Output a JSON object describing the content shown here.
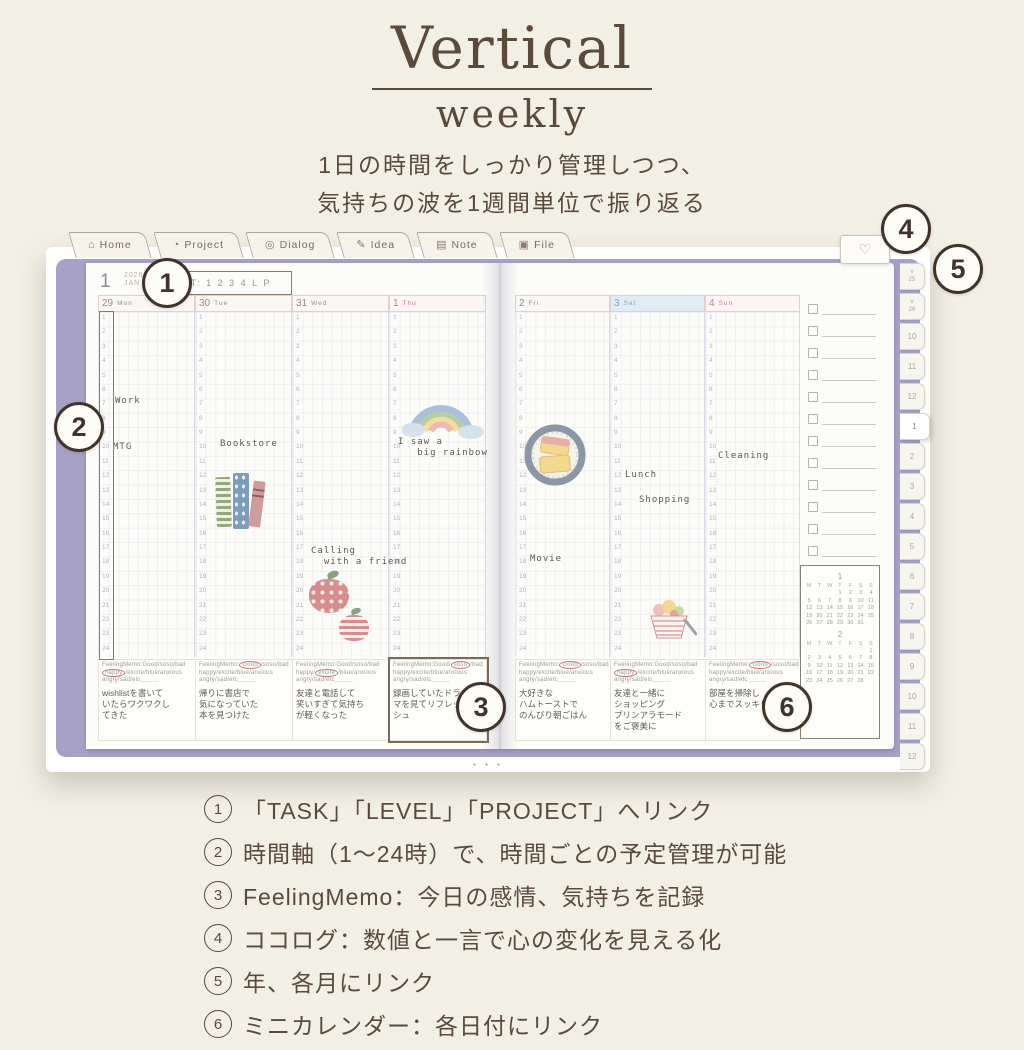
{
  "header": {
    "title": "Vertical",
    "subtitle": "weekly",
    "tagline1": "1日の時間をしっかり管理しつつ、",
    "tagline2": "気持ちの波を1週間単位で振り返る"
  },
  "tabs": [
    {
      "label": "Home",
      "icon": "home-icon",
      "glyph": "⌂"
    },
    {
      "label": "Project",
      "icon": "clock-icon",
      "glyph": "◔"
    },
    {
      "label": "Dialog",
      "icon": "target-icon",
      "glyph": "◎"
    },
    {
      "label": "Idea",
      "icon": "pencil-icon",
      "glyph": "✎"
    },
    {
      "label": "Note",
      "icon": "note-icon",
      "glyph": "▤"
    },
    {
      "label": "File",
      "icon": "folder-icon",
      "glyph": "▣"
    }
  ],
  "planner": {
    "heart_glyph": "♡",
    "month_num": "1",
    "year": "2026",
    "month_abbr": "JAN",
    "quick_links": "T: 1 2 3 4 L P",
    "hours_start": 1,
    "hours_end": 24,
    "memo_header_lines": [
      "FeelingMemo:Good/soso/bad",
      "happy/excite/blue/anxious",
      "angry/sad/etc＿＿＿"
    ],
    "days": [
      {
        "date": "29",
        "dow": "Mon",
        "style": "weekday",
        "axis_boxed": true,
        "entries": [
          {
            "text": "Work",
            "hour": 7,
            "dx": 16
          },
          {
            "text": "MTG",
            "hour": 10.2,
            "dx": 14
          }
        ],
        "stickers": [],
        "memo": {
          "circled": "happy",
          "note": "wishlistを書いて\nいたらワクワクし\nてきた"
        }
      },
      {
        "date": "30",
        "dow": "Tue",
        "style": "weekday",
        "entries": [
          {
            "text": "Bookstore",
            "hour": 10,
            "dx": 24
          }
        ],
        "stickers": [
          {
            "name": "books-sticker",
            "hour": 12.2,
            "dx": 20
          }
        ],
        "memo": {
          "circled": "Good",
          "note": "帰りに書店で\n気になっていた\n本を見つけた"
        }
      },
      {
        "date": "31",
        "dow": "Wed",
        "style": "weekday",
        "entries": [
          {
            "text": "Calling\n  with a friend",
            "hour": 17.4,
            "dx": 18
          }
        ],
        "stickers": [
          {
            "name": "apples-sticker",
            "hour": 19,
            "dx": 14
          }
        ],
        "memo": {
          "circled": "excite",
          "note": "友達と電話して\n笑いすぎて気持ち\nが軽くなった"
        }
      },
      {
        "date": "1",
        "dow": "Thu",
        "style": "holiday",
        "entries": [
          {
            "text": "I saw a\n   big rainbow",
            "hour": 9.8,
            "dx": 8
          }
        ],
        "stickers": [
          {
            "name": "rainbow-sticker",
            "hour": 6.8,
            "dx": 12
          }
        ],
        "memo": {
          "circled": "soso",
          "boxed": true,
          "note": "録画していたドラ\nマを見てリフレッ\nシュ"
        }
      },
      {
        "date": "2",
        "dow": "Fri",
        "style": "weekday",
        "entries": [
          {
            "text": "Movie",
            "hour": 18,
            "dx": 14
          }
        ],
        "stickers": [
          {
            "name": "toast-sticker",
            "hour": 8.8,
            "dx": 8
          }
        ],
        "memo": {
          "circled": "Good",
          "note": "大好きな\nハムトーストで\nのんびり朝ごはん"
        }
      },
      {
        "date": "3",
        "dow": "Sat",
        "style": "saturday",
        "entries": [
          {
            "text": "Lunch",
            "hour": 12.1,
            "dx": 14
          },
          {
            "text": "Shopping",
            "hour": 13.9,
            "dx": 28
          }
        ],
        "stickers": [
          {
            "name": "parfait-sticker",
            "hour": 21,
            "dx": 30
          }
        ],
        "memo": {
          "circled": "happy",
          "note": "友達と一緒に\nショッピング\nプリンアラモード\nをご褒美に"
        }
      },
      {
        "date": "4",
        "dow": "Sun",
        "style": "holiday",
        "entries": [
          {
            "text": "Cleaning",
            "hour": 10.8,
            "dx": 12
          }
        ],
        "stickers": [],
        "memo": {
          "circled": "Good",
          "note": "部屋を掃除し\n心までスッキリ"
        }
      }
    ],
    "side_tabs": [
      {
        "label": "Y",
        "sub": "25"
      },
      {
        "label": "Y",
        "sub": "26"
      },
      {
        "label": "10"
      },
      {
        "label": "11"
      },
      {
        "label": "12"
      },
      {
        "label": "1",
        "active": true
      },
      {
        "label": "2"
      },
      {
        "label": "3"
      },
      {
        "label": "4"
      },
      {
        "label": "5"
      },
      {
        "label": "6"
      },
      {
        "label": "7"
      },
      {
        "label": "8"
      },
      {
        "label": "9"
      },
      {
        "label": "10"
      },
      {
        "label": "11"
      },
      {
        "label": "12"
      }
    ],
    "checklist_count": 12,
    "mini_calendar": {
      "months": [
        {
          "title": "1",
          "dow": [
            "M",
            "T",
            "W",
            "T",
            "F",
            "S",
            "S"
          ],
          "weeks": [
            [
              "",
              "",
              "",
              "1",
              "2",
              "3",
              "4"
            ],
            [
              "5",
              "6",
              "7",
              "8",
              "9",
              "10",
              "11"
            ],
            [
              "12",
              "13",
              "14",
              "15",
              "16",
              "17",
              "18"
            ],
            [
              "19",
              "20",
              "21",
              "22",
              "23",
              "24",
              "25"
            ],
            [
              "26",
              "27",
              "28",
              "29",
              "30",
              "31",
              ""
            ]
          ]
        },
        {
          "title": "2",
          "dow": [
            "M",
            "T",
            "W",
            "T",
            "F",
            "S",
            "S"
          ],
          "weeks": [
            [
              "",
              "",
              "",
              "",
              "",
              "",
              "1"
            ],
            [
              "2",
              "3",
              "4",
              "5",
              "6",
              "7",
              "8"
            ],
            [
              "9",
              "10",
              "11",
              "12",
              "13",
              "14",
              "15"
            ],
            [
              "16",
              "17",
              "18",
              "19",
              "20",
              "21",
              "22"
            ],
            [
              "23",
              "24",
              "25",
              "26",
              "27",
              "28",
              ""
            ]
          ]
        }
      ]
    },
    "page_dots": "・・・"
  },
  "callouts": [
    {
      "num": "1"
    },
    {
      "num": "2"
    },
    {
      "num": "3"
    },
    {
      "num": "4"
    },
    {
      "num": "5"
    },
    {
      "num": "6"
    }
  ],
  "legend": [
    {
      "num": "1",
      "text": "「TASK」「LEVEL」「PROJECT」へリンク"
    },
    {
      "num": "2",
      "text": "時間軸（1～24時）で、時間ごとの予定管理が可能"
    },
    {
      "num": "3",
      "text": "FeelingMemo：今日の感情、気持ちを記録"
    },
    {
      "num": "4",
      "text": "ココログ：数値と一言で心の変化を見える化"
    },
    {
      "num": "5",
      "text": "年、各月にリンク"
    },
    {
      "num": "6",
      "text": "ミニカレンダー：各日付にリンク"
    }
  ],
  "colors": {
    "cover_purple": "#a8a1c6",
    "brown": "#5a4a3c",
    "holiday_red": "#c67f7f",
    "saturday_blue": "#89a3c4"
  }
}
